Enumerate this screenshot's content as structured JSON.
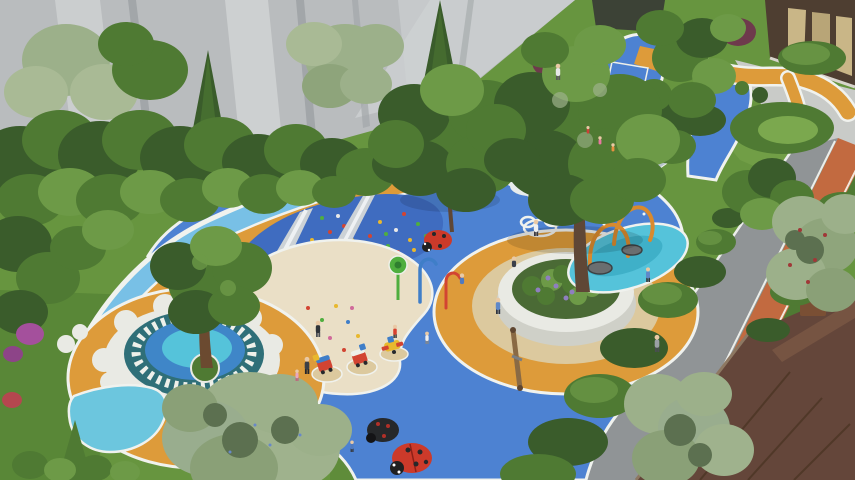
{
  "scene": {
    "description": "Aerial 3D rendering of a colorful community children's playground: blue rubber surfacing with white cloud motifs, sand pit with twin steel slides on a climbing mound, central tree with circular white bench and orange ring, ladybug sculptures, spring riders, splash pad with orange water arches, rainbow climbing slope, terraced lawns, winding orange paths, clipped hedges, a gray road with terracotta jogging track, gray high-rise facade top-left and brown residential buildings at right.",
    "colors": {
      "facade_gray": "#b9bcbe",
      "facade_light": "#cfd2d3",
      "facade_shadow": "#a2a6a9",
      "lawn_green": "#67953f",
      "lawn_dark": "#4f7c31",
      "lawn_light": "#7ba84e",
      "foliage_dark": "#3a5c2b",
      "foliage_mid": "#4f7a33",
      "foliage_light": "#6d9a47",
      "foliage_silver": "#9cb08a",
      "foliage_maroon": "#6e3a4c",
      "flower_magenta": "#a4509c",
      "play_blue": "#4d82d2",
      "play_blue_deep": "#3f6cc0",
      "play_blue_light": "#78c0e6",
      "splash_cyan": "#55c3da",
      "sand_beige": "#eadfc6",
      "path_orange": "#dd9b3a",
      "track_terracotta": "#c26a40",
      "road_gray": "#909496",
      "pavement_light": "#c9cbc8",
      "white_line": "#f0f2ee",
      "planter_white": "#e9eae4",
      "ring_tan": "#dcc99e",
      "slide_metal": "#ccd2d6",
      "ladybug_red": "#cc3a2a",
      "equip_red": "#d24432",
      "equip_yellow": "#e8b82e",
      "equip_green": "#4fae3e",
      "equip_blue": "#3f7ec8",
      "arch_orange": "#d98a2e",
      "roof_brown": "#64463a",
      "roof_brown_light": "#7d5a46",
      "teal_ring": "#2f6f78",
      "rainbow_pink": "#e06a74",
      "rainbow_orange": "#e2923c",
      "rainbow_teal": "#47b0a4",
      "rainbow_blue": "#7fb3d8",
      "terrace_green": "#aec868",
      "terrace_light": "#cfdf9b"
    },
    "objects": [
      "high-rise-facade",
      "tree-band",
      "lawns",
      "playground-blue-surface",
      "entry-color-bands",
      "climbing-mound",
      "steel-slides",
      "sand-pit",
      "mandala-plaza",
      "central-tree-bench",
      "splash-pad",
      "water-arches",
      "spray-poles",
      "rainbow-climber",
      "terraced-lawn",
      "walkway",
      "orange-paths",
      "sport-court",
      "spring-riders",
      "balance-beam",
      "ladybug-sculptures",
      "cloud-decals",
      "road",
      "jogging-track",
      "entrance-building",
      "brown-roof",
      "hedges",
      "people"
    ]
  }
}
